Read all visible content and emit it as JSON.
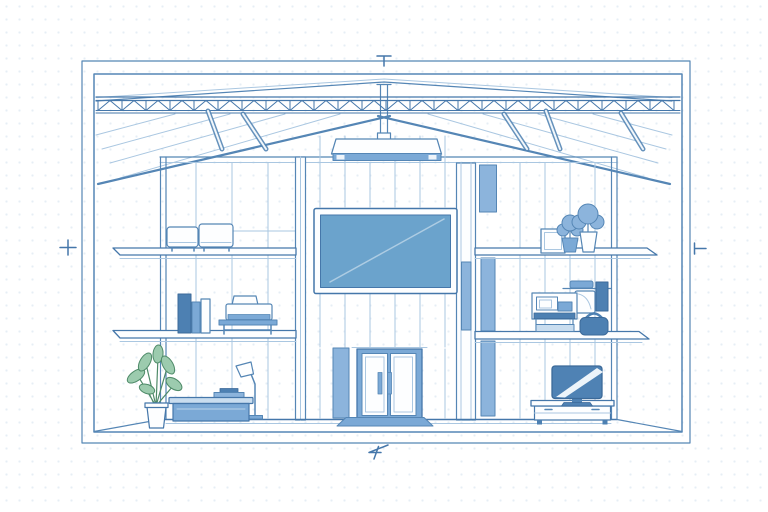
{
  "meta": {
    "description": "Blueprint-style cutaway cross-section illustration of a three-level interior with gabled roof truss, furniture and a large wall screen",
    "diagram_type": "architectural-cross-section"
  },
  "palette": {
    "background": "#ffffff",
    "dot_grid": "#e6eef5",
    "line_strong": "#4577aa",
    "line_medium": "#5586b5",
    "line_light": "#aac7e1",
    "fill_white": "#fdfeff",
    "fill_panel": "#8cb4dc",
    "fill_medium": "#7ba9d6",
    "fill_light": "#c9ddef",
    "fill_screen": "#6ba3cc",
    "fill_dark": "#4d80b2",
    "fill_tv": "#4f82b4",
    "leaf_fill": "#9ccbae",
    "leaf_stroke": "#4e8a68"
  },
  "dimension_marks": {
    "top": "T-tick",
    "left": "plus-tick",
    "right": "side-T-tick",
    "bottom": "squiggle-tick"
  },
  "scene": {
    "levels": [
      "upper-level",
      "middle-level",
      "ground-level"
    ],
    "structure": [
      "outer-frame",
      "inner-frame",
      "roof-ridge",
      "king-post",
      "roof-truss",
      "ceiling-panels",
      "hanger-braces",
      "wall-panels",
      "columns",
      "floor-slabs",
      "perspective-floor"
    ],
    "objects": [
      {
        "name": "pendant-light",
        "location": "center, hanging from roof peak"
      },
      {
        "name": "wall-screen",
        "location": "center wall, large blue display"
      },
      {
        "name": "storage-boxes",
        "location": "upper level left, two white rounded units"
      },
      {
        "name": "picture-frame",
        "location": "upper level right"
      },
      {
        "name": "shelf-plants",
        "location": "upper level right, two potted plants"
      },
      {
        "name": "books",
        "location": "middle level left"
      },
      {
        "name": "printer-on-stand",
        "location": "middle level left"
      },
      {
        "name": "desktop-workstation",
        "location": "middle level right, monitor and devices"
      },
      {
        "name": "shoulder-bag",
        "location": "middle level right"
      },
      {
        "name": "floor-plant",
        "location": "ground level left, green leaves"
      },
      {
        "name": "sideboard-desk",
        "location": "ground level left, blue cabinet"
      },
      {
        "name": "floor-lamp",
        "location": "ground level left"
      },
      {
        "name": "double-door",
        "location": "ground level center"
      },
      {
        "name": "door-mat",
        "location": "ground level center, below door"
      },
      {
        "name": "tv-on-console",
        "location": "ground level right"
      }
    ]
  }
}
